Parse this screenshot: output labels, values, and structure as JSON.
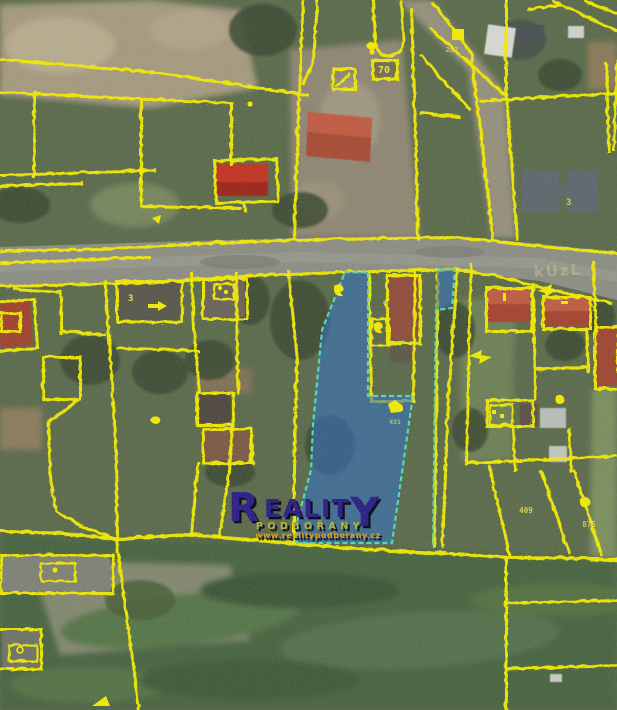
{
  "map": {
    "title": "Cadastral aerial map with highlighted parcel",
    "watermark": {
      "brand_first_letter": "R",
      "brand_middle": "EALIT",
      "brand_last_letter": "Y",
      "brand_full": "REALITY",
      "subtitle": "PODBOŘANY",
      "url": "www.realitypodborany.cz"
    },
    "road_text": "kÚzL",
    "parcel_labels": [
      {
        "text": "70"
      },
      {
        "text": "287"
      },
      {
        "text": "3"
      },
      {
        "text": "3"
      },
      {
        "text": "409"
      },
      {
        "text": "875"
      },
      {
        "text": "431"
      }
    ],
    "icon_names": [
      "parcel-marker-icon",
      "direction-arrow-icon",
      "bird-marker-icon",
      "house-marker-icon",
      "corner-arrow-icon"
    ],
    "highlighted_parcel": {
      "fill": "#2f6fc3",
      "border": "#54dfb2",
      "opacity": 0.58
    },
    "colors": {
      "line-yellow": "#f2ea00",
      "parcel-fill": "#2f6fc3",
      "parcel-border": "#54dfb2",
      "label-yellow": "#e8e24a",
      "watermark-navy": "#2a1e86",
      "watermark-olive": "#b9b23c",
      "watermark-orange": "#e09a1e"
    }
  }
}
